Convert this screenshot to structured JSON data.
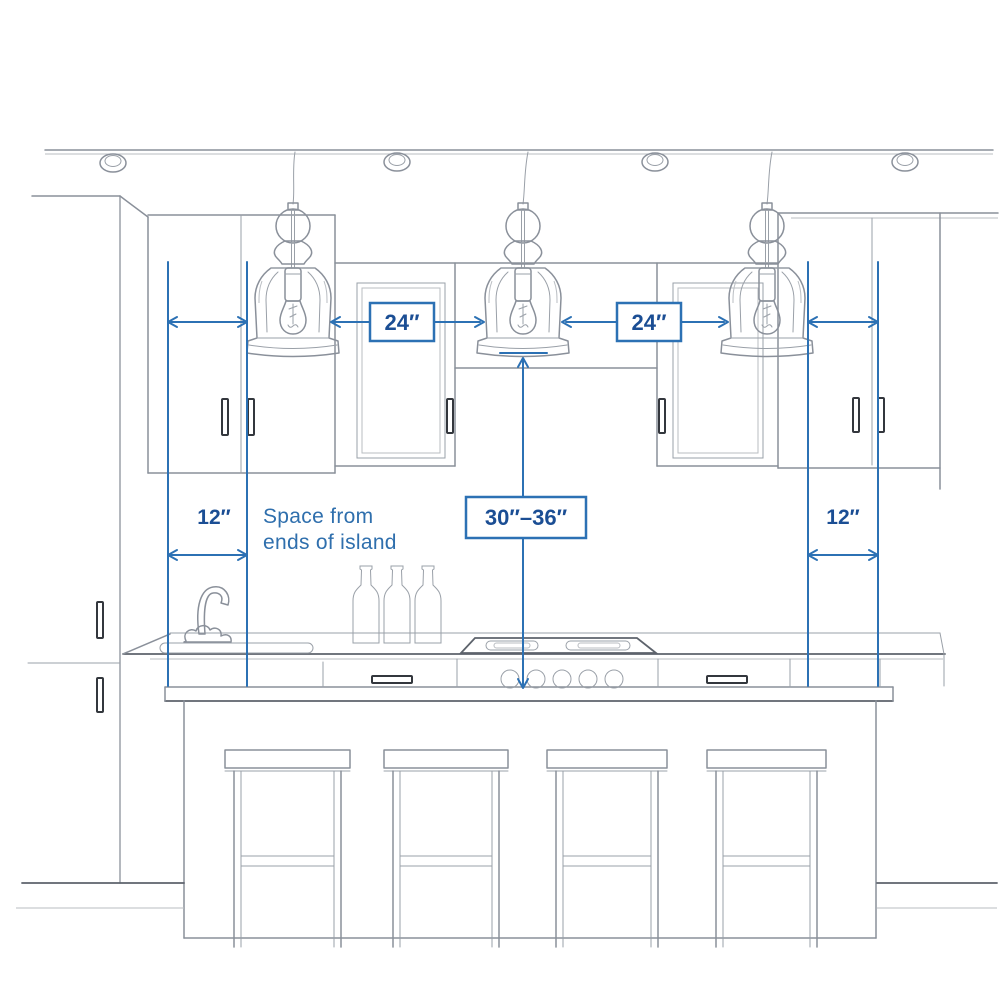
{
  "diagram": {
    "title": "Kitchen island pendant lighting spacing guide",
    "labels": {
      "pendant_spacing_left": "24″",
      "pendant_spacing_right": "24″",
      "hang_height": "30″–36″",
      "end_space_left": "12″",
      "end_space_right": "12″",
      "note_line1": "Space from",
      "note_line2": "ends of island"
    },
    "measurements": [
      {
        "name": "spacing-between-pendants",
        "value": "24″",
        "count": 2
      },
      {
        "name": "space-from-ends-of-island",
        "value": "12″",
        "count": 2
      },
      {
        "name": "height-above-countertop",
        "value": "30″–36″",
        "count": 1
      }
    ],
    "objects": {
      "recessed_ceiling_lights": 4,
      "pendant_lights": 3,
      "bar_stools": 4,
      "wine_bottles": 3,
      "cooktop_knobs": 5,
      "cabinet_handles": 10,
      "drawer_handles": 2,
      "sink": 1,
      "faucet": 1
    },
    "colors": {
      "dimension_blue": "#2c71b4",
      "label_navy": "#1b4e94",
      "note_blue": "#2f6fad",
      "sketch_gray": "#8a909a",
      "background": "#ffffff"
    }
  }
}
